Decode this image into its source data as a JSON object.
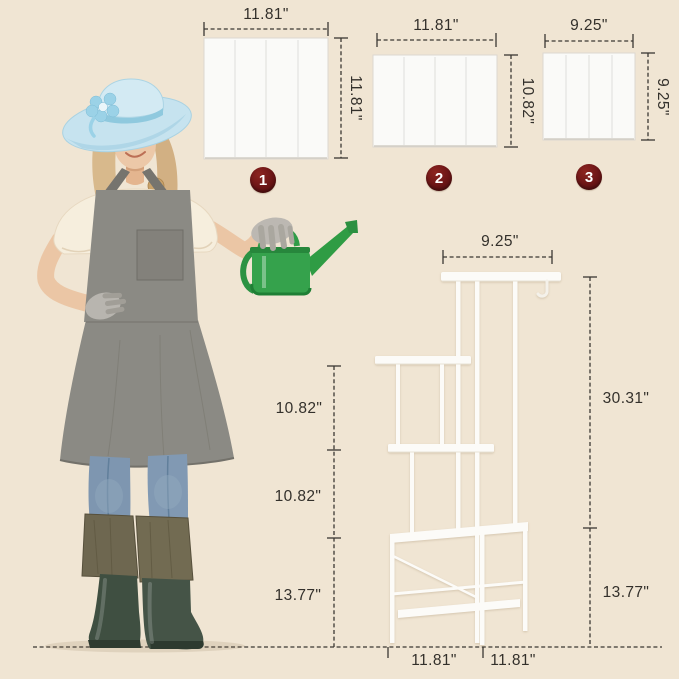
{
  "scene": {
    "background_color": "#f0e5d3",
    "badge_color": "#6b1516",
    "dimension_text_color": "#33302b",
    "stand_color": "#fcfbf8",
    "watering_can_color": "#2f9c44",
    "hat_color": "#c6e3ef",
    "apron_color": "#8b8a84"
  },
  "panels": [
    {
      "number": "1",
      "width_label": "11.81\"",
      "height_label": "11.81\""
    },
    {
      "number": "2",
      "width_label": "11.81\"",
      "height_label": "10.82\""
    },
    {
      "number": "3",
      "width_label": "9.25\"",
      "height_label": "9.25\""
    }
  ],
  "stand": {
    "top_width_label": "9.25\"",
    "upper_height_label": "30.31\"",
    "shelf_gap_1_label": "10.82\"",
    "shelf_gap_2_label": "10.82\"",
    "base_height_left_label": "13.77\"",
    "base_height_right_label": "13.77\"",
    "base_depth_label": "11.81\"",
    "base_width_label": "11.81\""
  }
}
